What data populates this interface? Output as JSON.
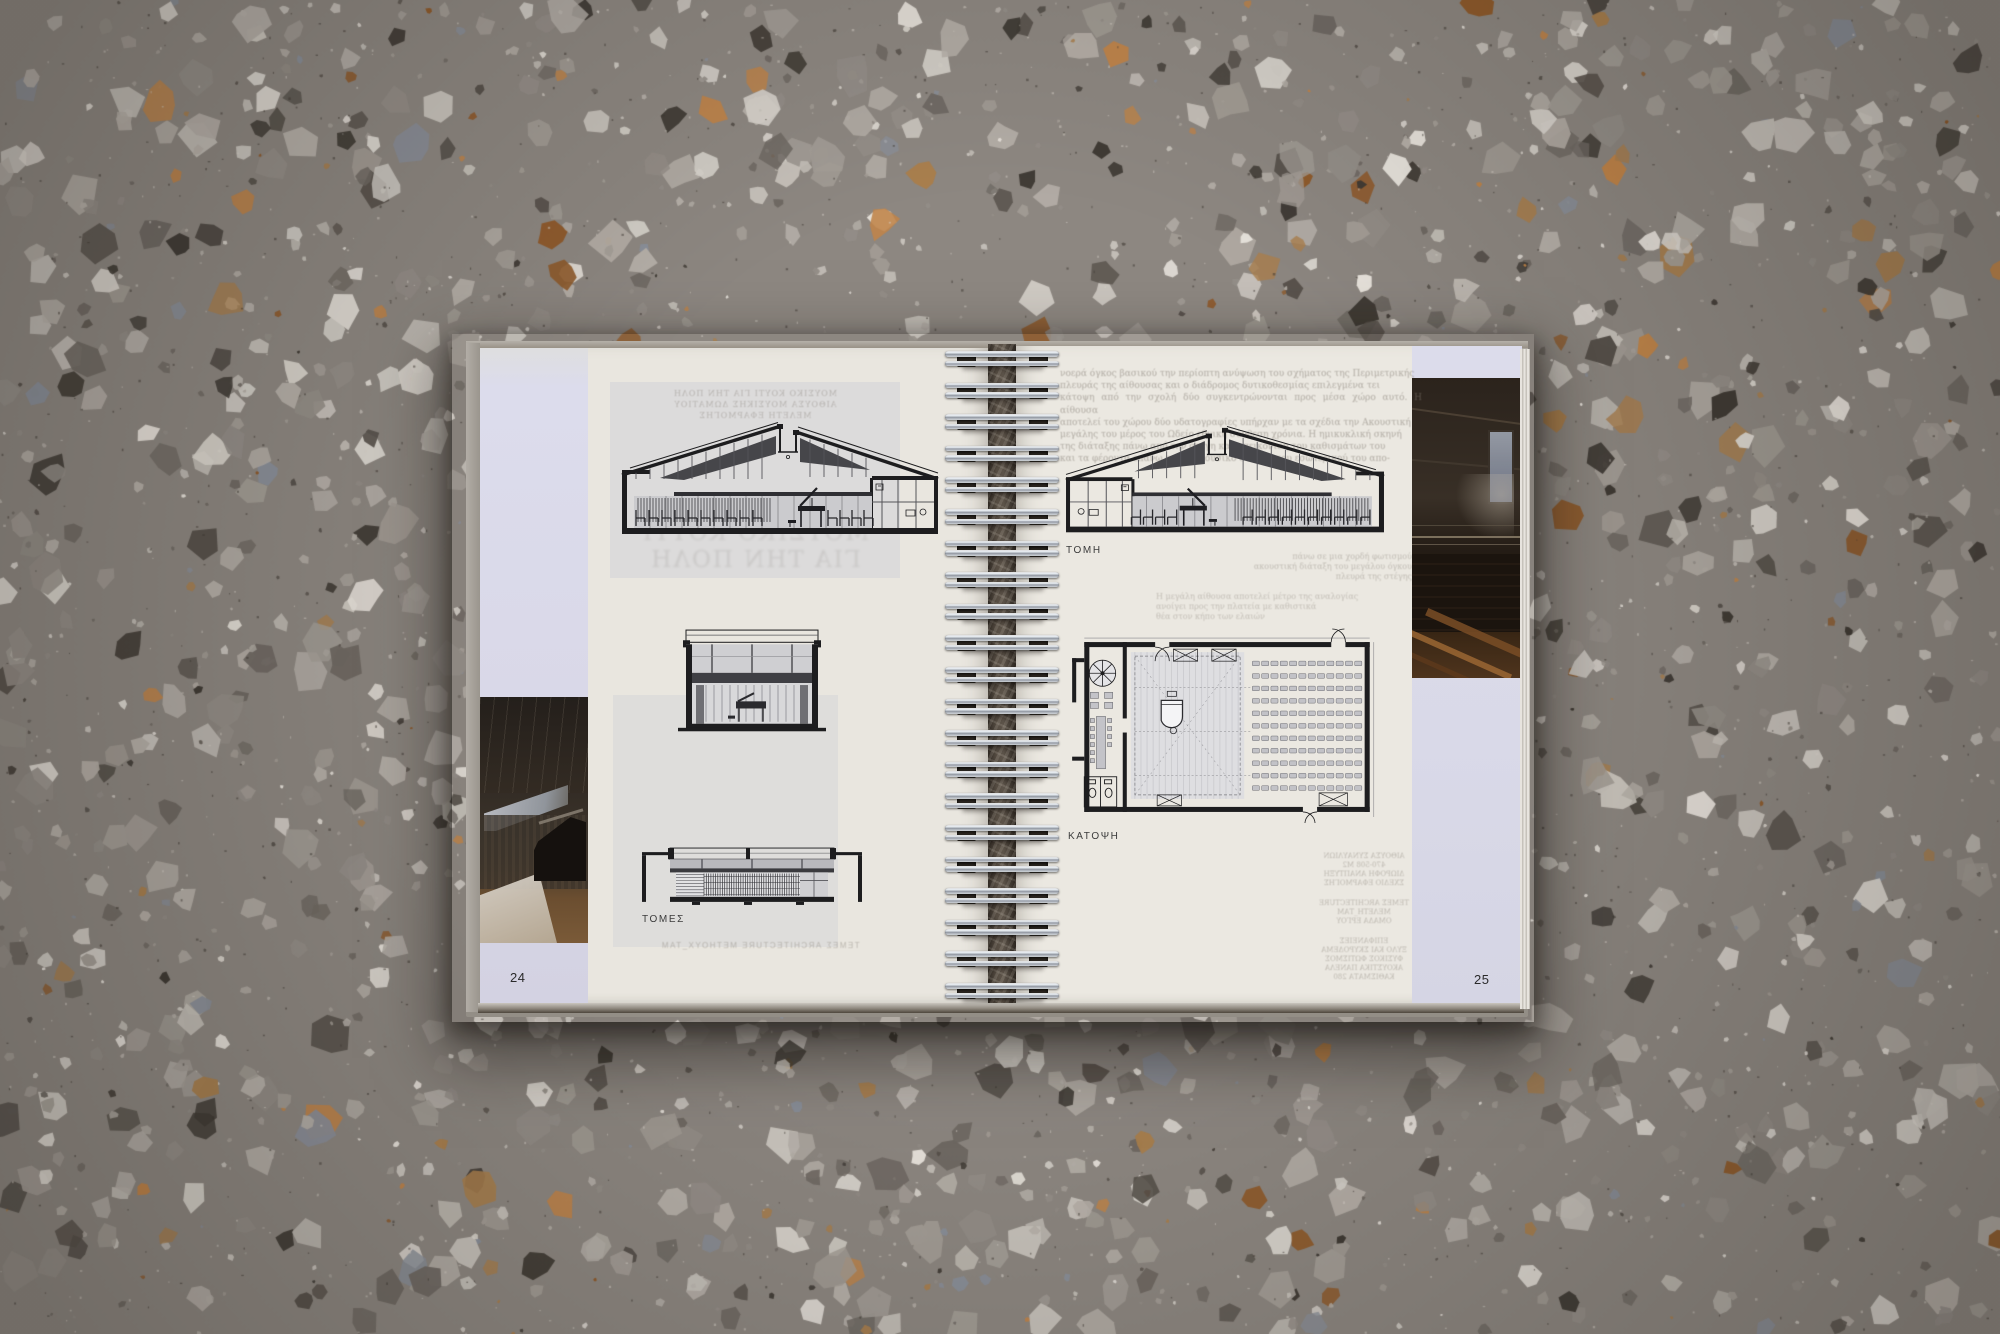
{
  "book": {
    "left_page": {
      "page_number": "24",
      "caption": "ΤΟΜΕΣ",
      "ghost_caption": "ΤΕΜΕΣ ARCHITECTURE ΜΕΤΗΟΥΧ_ΤΑΜ",
      "ghost_header_lines": [
        "ΜΟΥΣΙΚΟ ΚΟΥΤΙ ΓΙΑ ΤΗΝ ΠΟΛΗ",
        "ΑΙΘΟΥΣΑ ΜΟΥΣΙΚΗΣ ΔΩΜΑΤΙΟΥ",
        "ΜΕΛΕΤΗ ΕΦΑΡΜΟΓΗΣ"
      ],
      "ghost_title_lines": [
        "ΜΟΥΣΙΚΟ ΚΟΥΤΙ",
        "ΓΙΑ ΤΗΝ ΠΟΛΗ"
      ],
      "photo": "piano-rehearsal-hall-interior"
    },
    "right_page": {
      "page_number": "25",
      "section_label": "ΤΟΜΗ",
      "plan_label": "ΚΑΤΟΨΗ",
      "ghost_paragraph_lines": [
        "νοερά όγκος βασικού την περίοπτη ανύψωση του σχήματος της Περιμετρικής",
        "πλευράς της αίθουσας και ο διάδρομος δυτικοθεσμίας επιλεγμένα τει",
        "κάτοψη από την σχολή δύο συγκεντρώνονται προς μέσα χώρο αυτό. Η αίθουσα",
        "αποτελεί του χώρου δύο υδατογραφίες υπήρχαν με τα σχέδια την Ακουστική",
        "μεγάλης του μέρος του Ωδείο εθνική σύνθεση χρόνια. Η ημικυκλική σκηνή",
        "της διάταξης πάνω από την στέγη και απεικόνιση του καθισμάτων του",
        "και τα φέροντα επάνω από το μουσικό σταθμό του εσωτερικού του απο-"
      ],
      "ghost_mid_lines_1": [
        "πάνω σε μια χορδή φωτισμού",
        "ακουστική διάταξη του μεγάλου όγκου",
        "πλευρά της στέγης"
      ],
      "ghost_mid_lines_2": [
        "Η μεγάλη αίθουσα αποτελεί μέτρο της αναλογίας",
        "ανοίγει προς την πλατεία με καθιστικά",
        "θέα στον κήπο των ελαιών"
      ],
      "ghost_credit_clusters": [
        [
          "ΑΙΘΟΥΣΑ ΣΥΝΑΥΛΙΩΝ",
          "470-508 Μ2",
          "ΔΙΩΡΟΦΗ ΑΝΑΠΤΥΞΗ",
          "ΣΧΕΔΙΟ ΕΦΑΡΜΟΓΗΣ"
        ],
        [
          "ΤΕΜΕΣ ARCHITECTURE",
          "ΜΕΛΕΤΗ_ΤΑΜ",
          "ΟΜΑΔΑ ΕΡΓΟΥ"
        ],
        [
          "ΕΠΙΦΑΝΕΙΕΣ",
          "ΞΥΛΟ ΚΑΙ ΣΚΥΡΟΔΕΜΑ",
          "ΦΥΣΙΚΟΣ ΦΩΤΙΣΜΟΣ",
          "ΑΚΟΥΣΤΙΚΑ ΠΑΝΕΛΑ",
          "ΚΑΘΙΣΜΑΤΑ 280"
        ]
      ],
      "photo": "auditorium-interior-seating"
    },
    "binding": {
      "type": "wire-o-spiral",
      "coil_count": 21
    },
    "colors": {
      "page_cream": "#e9e6df",
      "accent_lavender": "#d9d8e8",
      "drawing_ink": "#1d1d1f",
      "floor_base": "#8d8781"
    }
  }
}
